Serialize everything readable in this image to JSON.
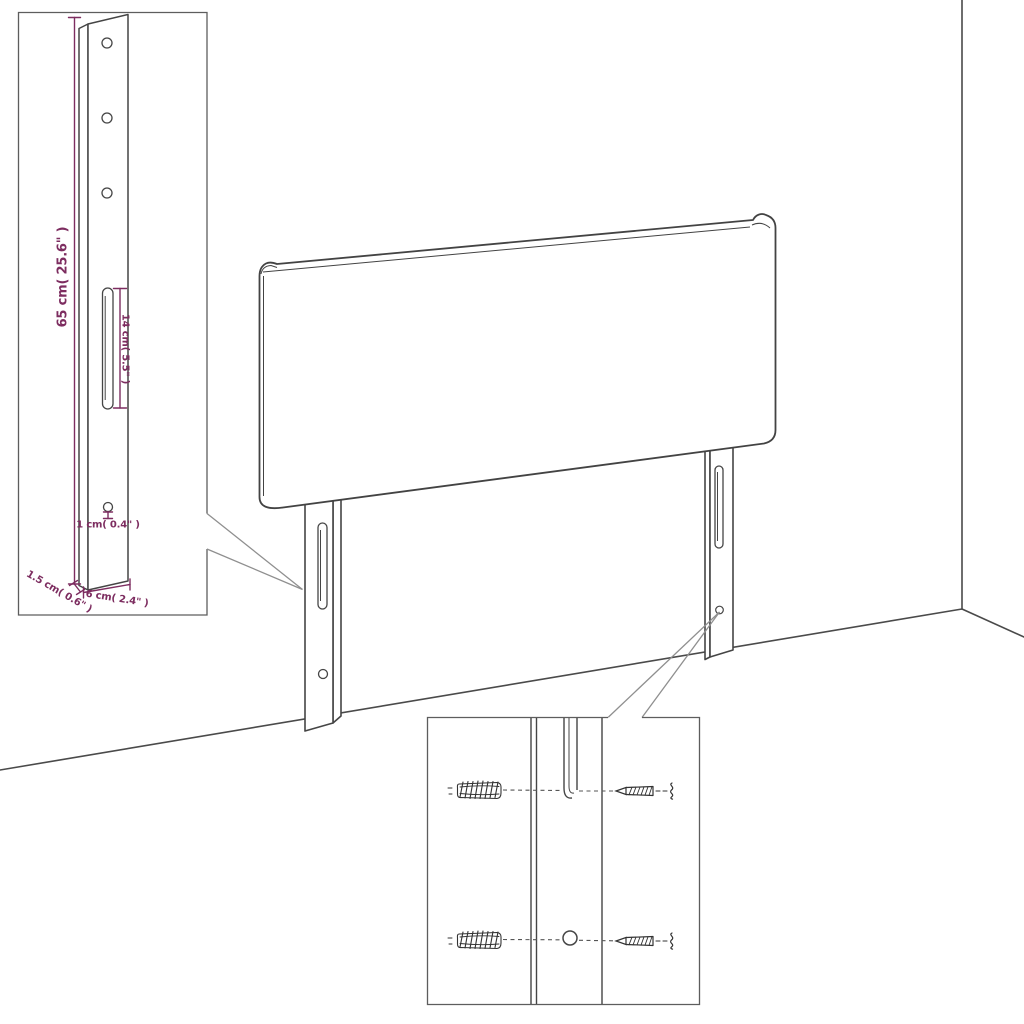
{
  "diagram": {
    "kind": "product dimension line drawing",
    "product": "upholstered headboard with two mounting legs",
    "colors": {
      "line": "#454545",
      "dimension": "#7d2d60",
      "callout": "#8f8f8f",
      "background": "#ffffff"
    },
    "insets": {
      "leg_detail": {
        "labels": {
          "height": "65 cm( 25.6\" )",
          "slot_length": "14 cm( 5.5\" )",
          "hole_diameter": "1 cm( 0.4\" )",
          "thickness": "1.5 cm( 0.6\" )",
          "width": "6 cm( 2.4\" )"
        }
      },
      "hardware_detail": {
        "wall_plugs": 2,
        "screws": 2
      }
    }
  }
}
